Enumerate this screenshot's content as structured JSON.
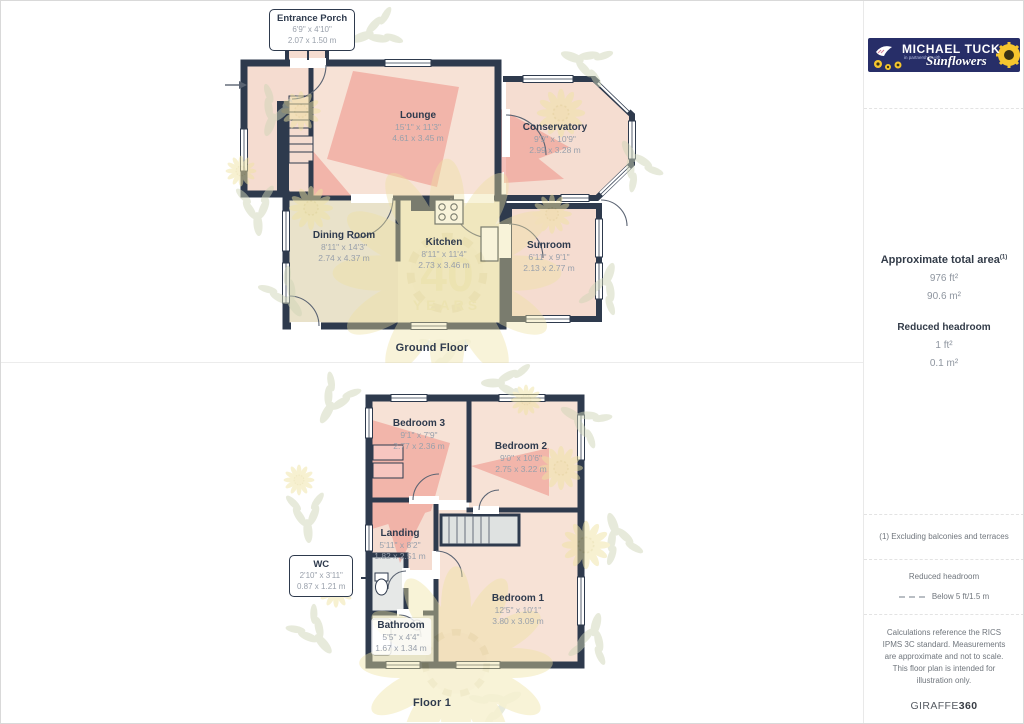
{
  "brand": {
    "agency": "MICHAEL TUCK",
    "partnership": "in partnership with",
    "partner": "Sunflowers"
  },
  "ground_floor": {
    "label": "Ground Floor",
    "callout": {
      "name": "Entrance Porch",
      "dims_ft": "6'9\" x 4'10\"",
      "dims_m": "2.07 x 1.50 m"
    },
    "rooms": [
      {
        "name": "Lounge",
        "dims_ft": "15'1\" x 11'3\"",
        "dims_m": "4.61 x 3.45 m"
      },
      {
        "name": "Conservatory",
        "dims_ft": "9'9\" x 10'9\"",
        "dims_m": "2.99 x 3.28 m"
      },
      {
        "name": "Dining Room",
        "dims_ft": "8'11\" x 14'3\"",
        "dims_m": "2.74 x 4.37 m"
      },
      {
        "name": "Kitchen",
        "dims_ft": "8'11\" x 11'4\"",
        "dims_m": "2.73 x 3.46 m"
      },
      {
        "name": "Sunroom",
        "dims_ft": "6'11\" x 9'1\"",
        "dims_m": "2.13 x 2.77 m"
      }
    ]
  },
  "floor1": {
    "label": "Floor 1",
    "callout": {
      "name": "WC",
      "dims_ft": "2'10\" x 3'11\"",
      "dims_m": "0.87 x 1.21 m"
    },
    "rooms": [
      {
        "name": "Bedroom 3",
        "dims_ft": "9'1\" x 7'9\"",
        "dims_m": "2.77 x 2.36 m"
      },
      {
        "name": "Bedroom 2",
        "dims_ft": "9'0\" x 10'6\"",
        "dims_m": "2.75 x 3.22 m"
      },
      {
        "name": "Landing",
        "dims_ft": "5'11\" x 8'2\"",
        "dims_m": "1.82 x 2.51 m"
      },
      {
        "name": "Bedroom 1",
        "dims_ft": "12'5\" x 10'1\"",
        "dims_m": "3.80 x 3.09 m"
      },
      {
        "name": "Bathroom",
        "dims_ft": "5'5\" x 4'4\"",
        "dims_m": "1.67 x 1.34 m"
      }
    ]
  },
  "watermark": {
    "line1": "40",
    "line2": "YEARS"
  },
  "sidebar": {
    "area_title": "Approximate total area",
    "area_superscript": "(1)",
    "area_ft": "976 ft²",
    "area_m": "90.6 m²",
    "headroom_title": "Reduced headroom",
    "headroom_ft": "1 ft²",
    "headroom_m": "0.1 m²",
    "note_exclusions": "(1) Excluding balconies and terraces",
    "legend_title": "Reduced headroom",
    "legend_value": "Below 5 ft/1.5 m",
    "disclaimer": "Calculations reference the RICS IPMS 3C standard. Measurements are approximate and not to scale. This floor plan is intended for illustration only.",
    "credit_brand": "GIRAFFE",
    "credit_suffix": "360"
  },
  "colors": {
    "wall": "#2e3a4d",
    "room_peach": "#f7e2d6",
    "room_pink": "#f5dcd0",
    "room_beige": "#e9e2ca",
    "room_cream": "#f2ebd3",
    "room_grey": "#e3e6e5",
    "camera_fov": "#ef9a90",
    "watermark_leaf": "#cfd5b6",
    "watermark_petal": "#eee2a2",
    "brand_navy": "#272e68",
    "brand_yellow": "#f6c62e"
  }
}
